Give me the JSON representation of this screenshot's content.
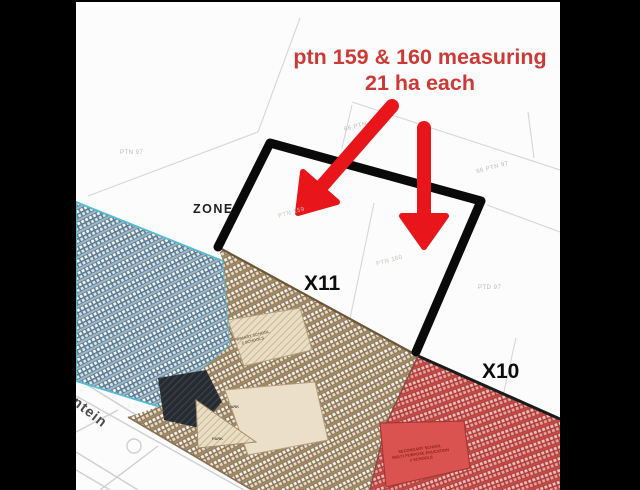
{
  "annotation": {
    "line1": "ptn 159 & 160 measuring",
    "line2": "21 ha each"
  },
  "labels": {
    "zone": "ZONE",
    "x11": "X11",
    "x10": "X10",
    "road": "ontein"
  },
  "parcels": [
    {
      "text": "PTN 97"
    },
    {
      "text": "66 PTN"
    },
    {
      "text": "66 PTN 97"
    },
    {
      "text": "PTN 159"
    },
    {
      "text": "PTN 160"
    },
    {
      "text": "PTD 97"
    }
  ],
  "sites": {
    "primary_line1": "PRIMARY SCHOOL",
    "primary_line2": "2 SCHOOLS",
    "park1": "PARK",
    "park2": "PARK",
    "secondary_line1": "SECONDARY SCHOOL",
    "secondary_line2": "MULTI PURPOSE EDUCATION",
    "secondary_line3": "2 SCHOOLS"
  },
  "colors": {
    "annotation_red": "#cd3a36",
    "arrow_red": "#e8161b",
    "boundary_black": "#0a0a0a",
    "zone_blue": "#b9cfdd",
    "zone_tan": "#b5a07d",
    "zone_red": "#d35b58",
    "letterbox": "#000000"
  }
}
